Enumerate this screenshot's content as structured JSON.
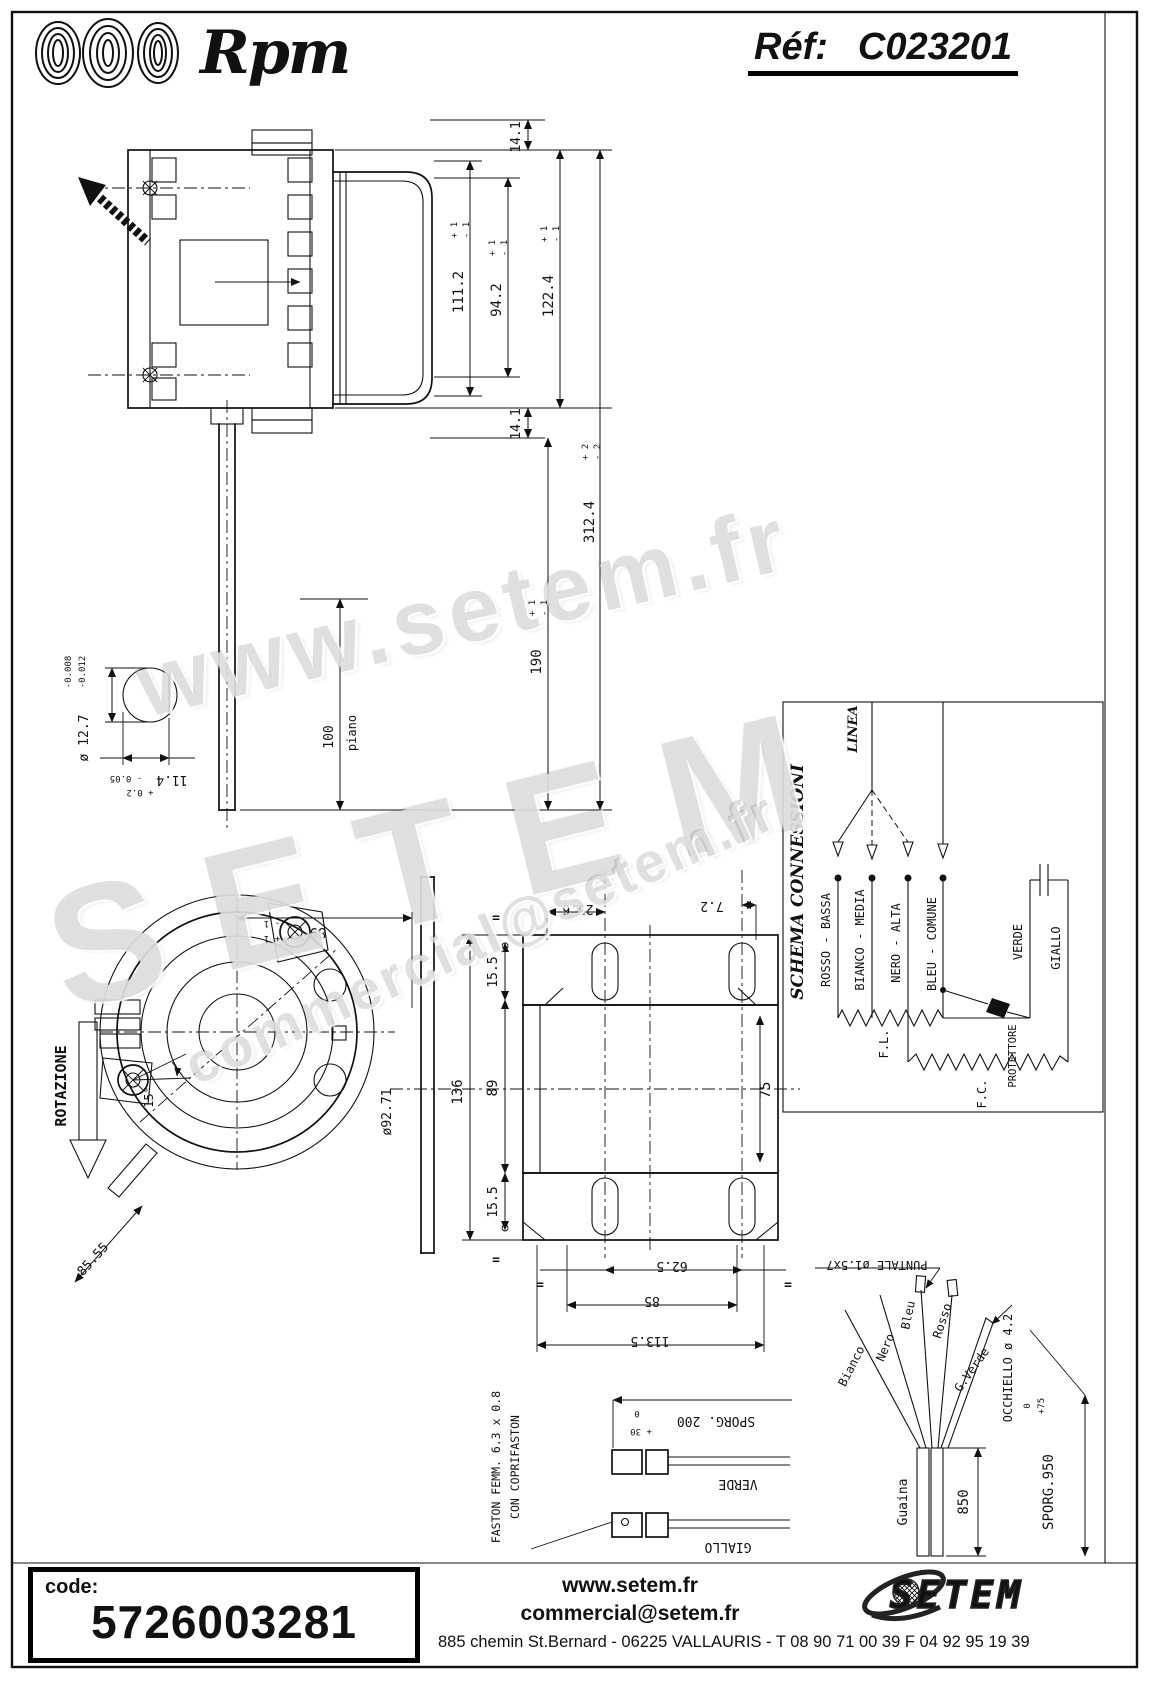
{
  "header": {
    "brand": "Rpm",
    "ref_label": "Réf:",
    "ref_value": "C023201"
  },
  "title_block": {
    "logo_brand": "Rpm",
    "logo_sub": "motori elettrici",
    "revisions": {
      "col_ind": "IND",
      "col_data": "DATA",
      "col_modifiche": "MODIFICHE",
      "col_disegnato": "DISEGNATO",
      "col_controllato": "CONTROLLATO",
      "r0": {
        "ind": "—",
        "date": "—",
        "desc": "",
        "by": "—"
      },
      "r1": {
        "ind": "4",
        "date": "12/01/05",
        "desc": "PASSATO A COD. DEFINITIVO ERA: SPC0959",
        "by": "BACCHIEGA"
      },
      "r2": {
        "ind": "3",
        "date": "08/10/04",
        "desc": "ALLUNGATO SPORG.ALBERO ERA: 150MM",
        "by": "BACCHIEGA"
      },
      "r3": {
        "ind": "2",
        "date": "09/04/03",
        "desc": "CAMBIATO NOME CLIENTE ERA: ITAL SERVICE-TOLTO WATT OUT",
        "by": "BACCHIEGA"
      },
      "r4": {
        "ind": "1",
        "date": "11/03/03",
        "desc": "MODIF. DATI: VOLT/ HZ/AMP. ERANO: 230/50 - 0.65",
        "by": "BACCHIEGA"
      }
    },
    "sostituisce_label": "SOSTITUISCE PARI NUMERO DEL",
    "sostituisce_value": "—",
    "data_label": "DATA",
    "data_value": "10/03/03",
    "scala_label": "SCALA",
    "scala_value": "1/1",
    "disegnato_label": "DISEGNATO",
    "disegnato_value": "BACCHIEGA",
    "controllato_label": "CONTROLLATO",
    "codice_cliente_label": "CODICE CLIENTE",
    "tipo_label": "TIPO MOTORE",
    "tipo_value": "MONOFASE CHIUSO",
    "carat_label": "CARAT. MECCANICHE",
    "carat_value": "—",
    "volt_label": "VOLT",
    "volt_value": "127",
    "hz_label": "HZ",
    "hz_value": "60",
    "amp_label": "AMP.",
    "amp_value": "0.64",
    "watt_label": "WATT",
    "watt_value": "77",
    "hp_label": "HP",
    "hp_value": "—",
    "uf_label": "µF",
    "uf_value": "5",
    "vc_label": "VC",
    "vc_value": "450",
    "giri_label": "GIRI",
    "giri_value": "1100",
    "poli_label": "POLI",
    "poli_value": "4",
    "cl_label": "CL.",
    "cl_value": "B",
    "nvel_label": "N° VEL.",
    "nvel_value": "3",
    "cliente_label": "CLIENTE",
    "cliente_value": "H54",
    "codice_motore_label": "CODICE MOTORE",
    "codice_motore_value": "C0232.01"
  },
  "schema": {
    "title": "SCHEMA CONNESSIONI",
    "linea": "LINEA",
    "rosso": "ROSSO - BASSA",
    "bianco": "BIANCO - MEDIA",
    "nero": "NERO - ALTA",
    "bleu": "BLEU - COMUNE",
    "verde": "VERDE",
    "giallo": "GIALLO",
    "fl": "F.L.",
    "fc": "F.C.",
    "prot": "PROTETTORE"
  },
  "dims": {
    "eq": "=",
    "d141_top": "14.1",
    "d141_bot": "14.1",
    "d1112": {
      "v": "111.2",
      "p": "+ 1",
      "m": "- 1"
    },
    "d942": {
      "v": "94.2",
      "p": "+ 1",
      "m": "- 1"
    },
    "d1224": {
      "v": "122.4",
      "p": "+ 1",
      "m": "- 1"
    },
    "d190": {
      "v": "190",
      "p": "+ 1",
      "m": "- 1"
    },
    "d3124": {
      "v": "312.4",
      "p": "+ 2",
      "m": "- 2"
    },
    "d100": "100",
    "piano": "piano",
    "d127": {
      "v": "ø 12.7",
      "p": "-0.008",
      "m": "-0.012"
    },
    "d114": {
      "v": "11.4",
      "p": "+ 0.2",
      "m": "- 0.05"
    },
    "d89rear": {
      "v": "89",
      "p": "+ 1",
      "m": "- 1"
    },
    "d9271": "ø92.71",
    "rotazione": "ROTAZIONE",
    "d15": "15°",
    "d8555": "85.55",
    "d256": "25.6",
    "d72": "7.2",
    "d136": "136",
    "d89": "89",
    "d155_top": "15.5",
    "d155_bot": "15.5",
    "d75": "75",
    "d625": "62.5",
    "d85": "85",
    "d1135": "113.5"
  },
  "faston": {
    "line1": "FASTON FEMM. 6.3 x 0.8",
    "line2": "CON COPRIFASTON",
    "sporg": {
      "v": "SPORG. 200",
      "p": "+ 30",
      "m": "0"
    },
    "verde": "VERDE",
    "giallo": "GIALLO"
  },
  "cable": {
    "bianco": "Bianco",
    "nero": "Nero",
    "bleu": "Bleu",
    "rosso": "Rosso",
    "gverde": "G.Verde",
    "guaina": "Guaina",
    "d850": "850",
    "sporg": {
      "v": "SPORG.950",
      "p": "+75",
      "m": "0"
    },
    "occhiello": "OCCHIELLO ø 4.2",
    "puntale": "PUNTALE ø1.5x7"
  },
  "watermarks": {
    "wm1": "www.setem.fr",
    "wm2": "SETEM",
    "wm3": "commercial@setem.fr"
  },
  "footer": {
    "code_label": "code:",
    "code_value": "5726003281",
    "site": "www.setem.fr",
    "email": "commercial@setem.fr",
    "brand": "SETEM",
    "address": "885 chemin St.Bernard  -  06225 VALLAURIS  -  T 08 90 71 00 39   F 04 92 95 19 39"
  }
}
